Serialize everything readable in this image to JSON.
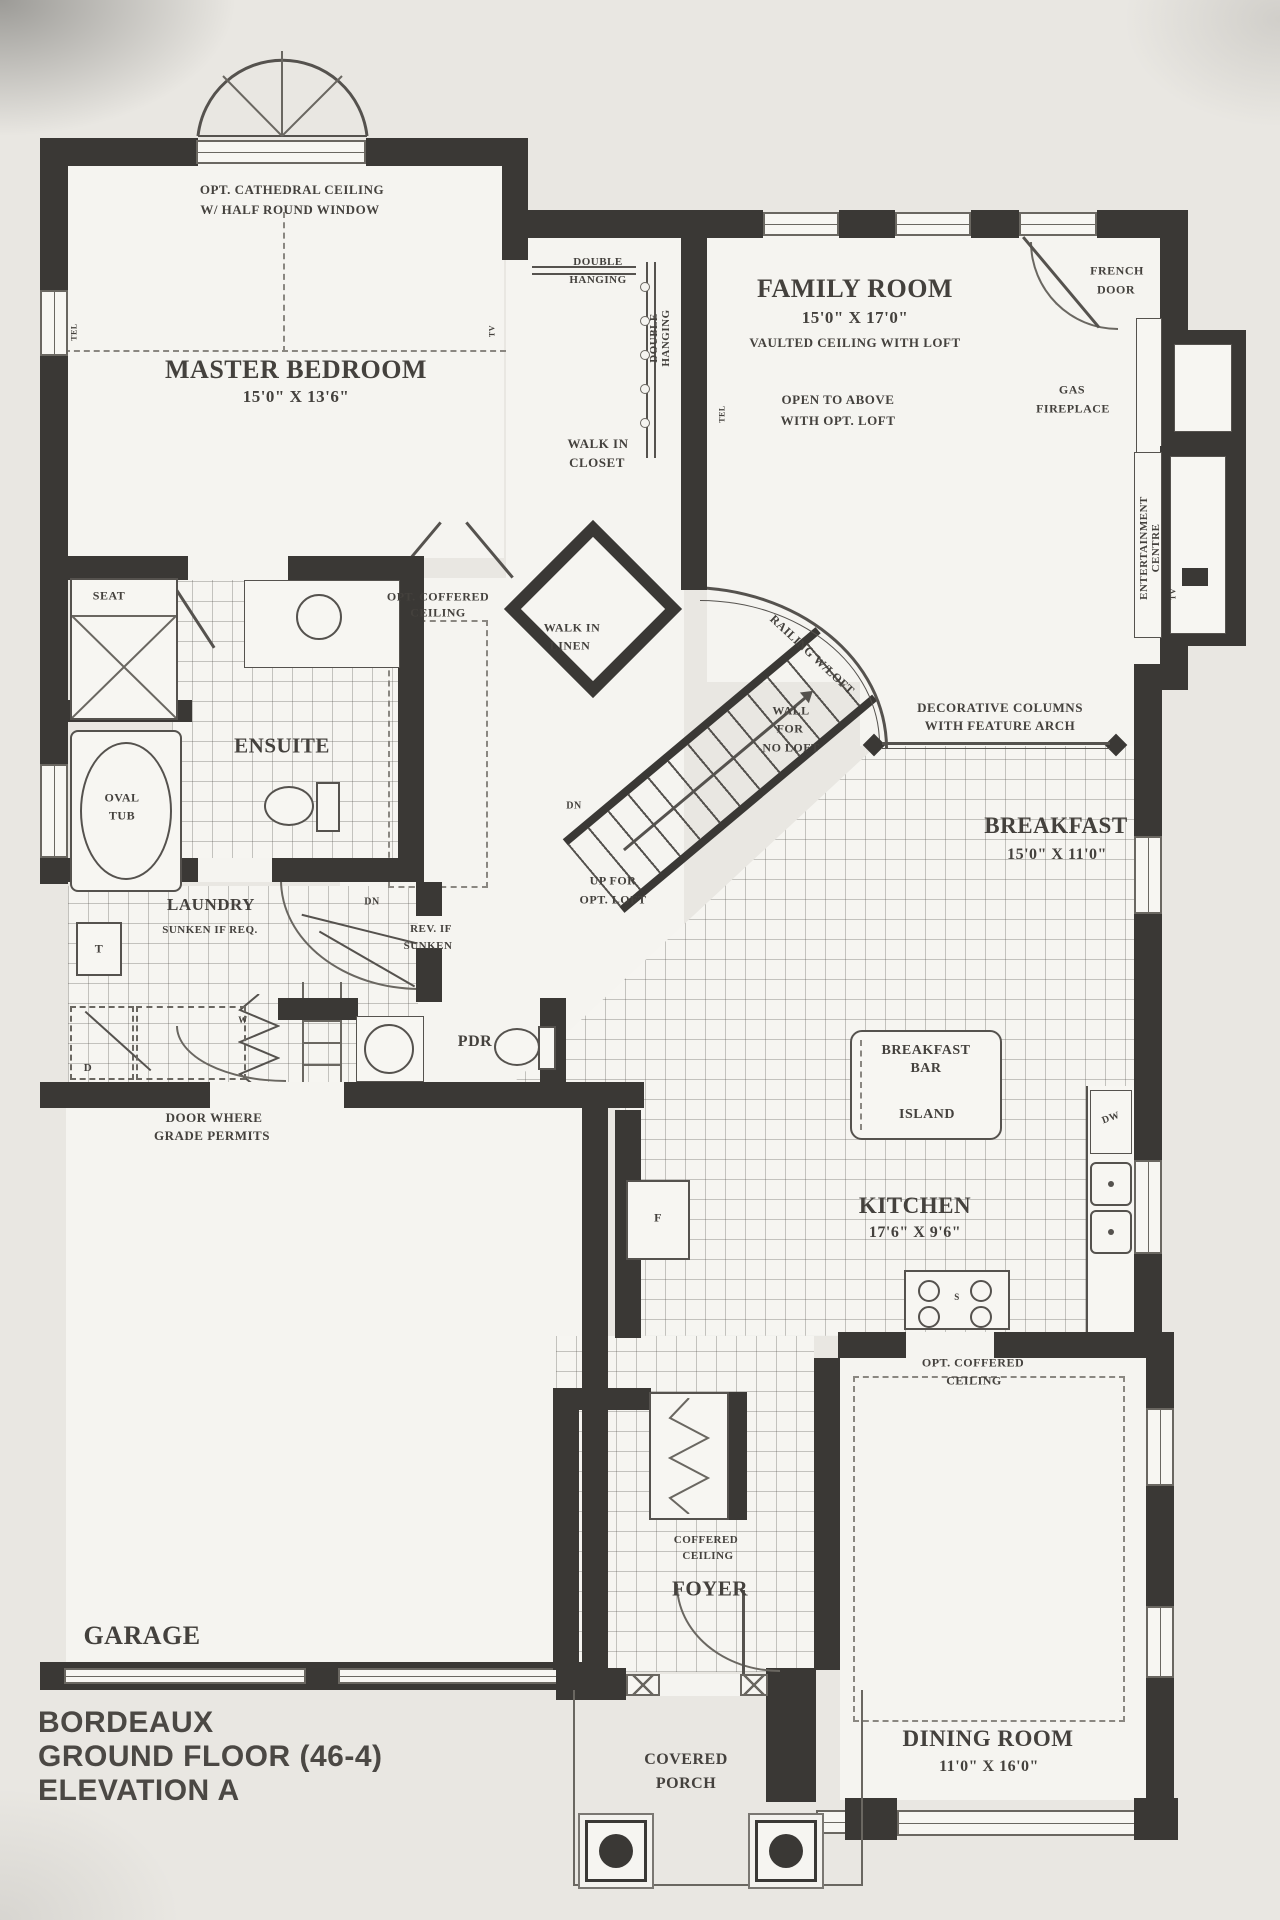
{
  "document": {
    "type": "architectural floor plan",
    "plan_name": "BORDEAUX",
    "floor": "GROUND FLOOR (46-4)",
    "elevation": "ELEVATION A"
  },
  "colors": {
    "paper": "#e9e7e2",
    "wall": "#3a3835",
    "line": "#6a6761",
    "text": "#44413d",
    "room": "#f5f4f0"
  },
  "labels": {
    "opt_cathedral_1": "OPT. CATHEDRAL CEILING",
    "opt_cathedral_2": "W/ HALF ROUND WINDOW",
    "master_name": "MASTER BEDROOM",
    "master_dims": "15'0\" X 13'6\"",
    "tel": "TEL",
    "tv": "TV",
    "double_hanging_1": "DOUBLE",
    "double_hanging_2": "HANGING",
    "family_name": "FAMILY ROOM",
    "family_dims": "15'0\" X 17'0\"",
    "family_note": "VAULTED CEILING WITH LOFT",
    "french_1": "FRENCH",
    "french_2": "DOOR",
    "open_above_1": "OPEN TO ABOVE",
    "open_above_2": "WITH OPT. LOFT",
    "gas_1": "GAS",
    "gas_2": "FIREPLACE",
    "walk_in_closet_1": "WALK IN",
    "walk_in_closet_2": "CLOSET",
    "entertainment_1": "ENTERTAINMENT",
    "entertainment_2": "CENTRE",
    "seat": "SEAT",
    "opt_coffered_1": "OPT. COFFERED",
    "opt_coffered_2": "CEILING",
    "walk_in_linen_1": "WALK IN",
    "walk_in_linen_2": "LINEN",
    "railing": "RAILING W/LOFT",
    "wall_no_loft_1": "WALL",
    "wall_no_loft_2": "FOR",
    "wall_no_loft_3": "NO LOFT",
    "decorative_1": "DECORATIVE COLUMNS",
    "decorative_2": "WITH FEATURE ARCH",
    "ensuite": "ENSUITE",
    "oval_tub_1": "OVAL",
    "oval_tub_2": "TUB",
    "dn": "DN",
    "breakfast_name": "BREAKFAST",
    "breakfast_dims": "15'0\" X 11'0\"",
    "up_loft_1": "UP FOR",
    "up_loft_2": "OPT. LOFT",
    "laundry_name": "LAUNDRY",
    "laundry_note": "SUNKEN IF REQ.",
    "rev_sunken_1": "REV. IF",
    "rev_sunken_2": "SUNKEN",
    "tub_t": "T",
    "dryer_d": "D",
    "washer_w": "W",
    "pdr": "PDR",
    "door_grade_1": "DOOR WHERE",
    "door_grade_2": "GRADE PERMITS",
    "breakfast_bar_1": "BREAKFAST",
    "breakfast_bar_2": "BAR",
    "island": "ISLAND",
    "dw": "DW",
    "kitchen_name": "KITCHEN",
    "kitchen_dims": "17'6\" X 9'6\"",
    "fridge_f": "F",
    "stove_s": "S",
    "dining_coffered_1": "OPT. COFFERED",
    "dining_coffered_2": "CEILING",
    "foyer_coffered_1": "COFFERED",
    "foyer_coffered_2": "CEILING",
    "foyer": "FOYER",
    "garage": "GARAGE",
    "covered_porch_1": "COVERED",
    "covered_porch_2": "PORCH",
    "dining_name": "DINING ROOM",
    "dining_dims": "11'0\" X 16'0\"",
    "title_1": "BORDEAUX",
    "title_2": "GROUND FLOOR (46-4)",
    "title_3": "ELEVATION A"
  }
}
